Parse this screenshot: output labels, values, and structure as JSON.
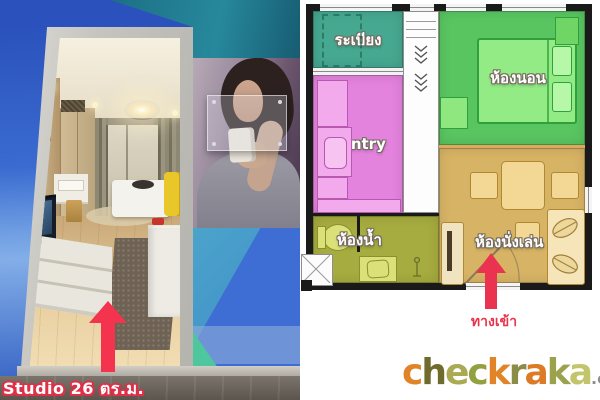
{
  "left_panel": {
    "caption": "Studio 26 ตร.ม.",
    "arrow_color": "#F4334E"
  },
  "floor_plan": {
    "rooms": [
      {
        "name": "balcony",
        "label": "ระเบียง",
        "color": "#46A890"
      },
      {
        "name": "pantry",
        "label": "Pantry",
        "color": "#E383DD"
      },
      {
        "name": "bedroom",
        "label": "ห้องนอน",
        "color": "#59C561"
      },
      {
        "name": "bathroom",
        "label": "ห้องน้ำ",
        "color": "#A6AC3F"
      },
      {
        "name": "living-room",
        "label": "ห้องนั่งเล่น",
        "color": "#D7B365"
      }
    ],
    "entrance": {
      "label": "ทางเข้า",
      "arrow_color": "#EA3350"
    }
  },
  "branding": {
    "letters": [
      {
        "char": "c",
        "color": "#E08427"
      },
      {
        "char": "h",
        "color": "#6F6B2D"
      },
      {
        "char": "e",
        "color": "#A9AA52"
      },
      {
        "char": "c",
        "color": "#93A03F"
      },
      {
        "char": "k",
        "color": "#E08427"
      },
      {
        "char": "r",
        "color": "#8C8C49"
      },
      {
        "char": "a",
        "color": "#DD7A25"
      },
      {
        "char": "k",
        "color": "#9CA24C"
      },
      {
        "char": "a",
        "color": "#C3C56C"
      }
    ],
    "tld": ".com"
  }
}
